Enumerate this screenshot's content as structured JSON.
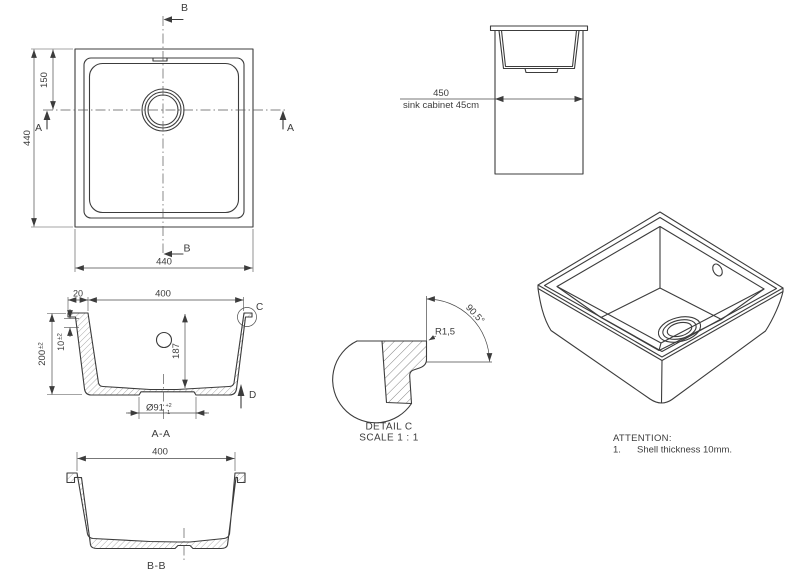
{
  "plan": {
    "marker_a": "A",
    "marker_b": "B",
    "dim_left": "440",
    "dim_offset": "150",
    "dim_bottom": "440"
  },
  "cabinet": {
    "dim": "450",
    "caption": "sink cabinet 45cm"
  },
  "section_aa": {
    "dim_rim": "20",
    "dim_width": "400",
    "dim_depth": "187",
    "dim_height": "200",
    "dim_height_tol": "±2",
    "dim_shell": "10",
    "dim_shell_tol": "±2",
    "dim_drain": "Ø91",
    "tol_plus": "+2",
    "tol_minus": "-1",
    "detail_marker": "C",
    "direction_marker": "D",
    "label": "A-A"
  },
  "detail_c": {
    "radius": "R1,5",
    "angle": "90.5°",
    "title": "DETAIL C",
    "scale": "SCALE 1 : 1"
  },
  "section_bb": {
    "dim_width": "400",
    "label": "B-B"
  },
  "attention": {
    "heading": "ATTENTION:",
    "item_number": "1.",
    "item_text": "Shell thickness 10mm."
  }
}
